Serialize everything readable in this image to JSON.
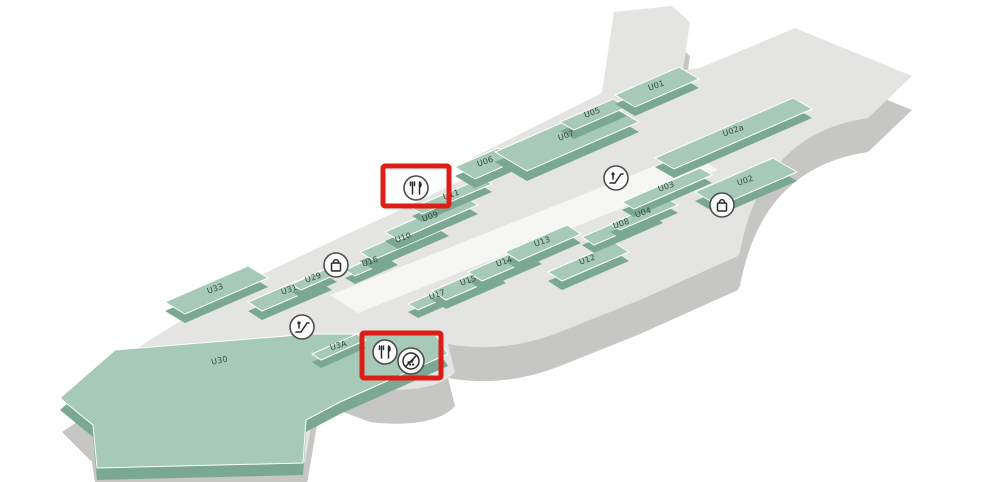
{
  "map": {
    "units": [
      {
        "label": "U01"
      },
      {
        "label": "U02a"
      },
      {
        "label": "U02"
      },
      {
        "label": "U03"
      },
      {
        "label": "U04"
      },
      {
        "label": "U05"
      },
      {
        "label": "U06"
      },
      {
        "label": "U07"
      },
      {
        "label": "U08"
      },
      {
        "label": "U09"
      },
      {
        "label": "U10"
      },
      {
        "label": "U11"
      },
      {
        "label": "U12"
      },
      {
        "label": "U13"
      },
      {
        "label": "U14"
      },
      {
        "label": "U15"
      },
      {
        "label": "U16"
      },
      {
        "label": "U17"
      },
      {
        "label": "U29"
      },
      {
        "label": "U31"
      },
      {
        "label": "U33"
      },
      {
        "label": "U3A"
      },
      {
        "label": "U30"
      }
    ],
    "amenity_icons": [
      {
        "name": "dining-icon",
        "symbol": "fork-knife",
        "highlighted": true
      },
      {
        "name": "dining-icon",
        "symbol": "fork-knife",
        "highlighted": true
      },
      {
        "name": "no-cart-icon",
        "symbol": "circle-slash",
        "highlighted": true
      },
      {
        "name": "escalator-icon",
        "symbol": "escalator",
        "highlighted": false
      },
      {
        "name": "escalator-icon",
        "symbol": "escalator",
        "highlighted": false
      },
      {
        "name": "shopping-icon",
        "symbol": "shopping-bag",
        "highlighted": false
      },
      {
        "name": "shopping-icon",
        "symbol": "shopping-bag",
        "highlighted": false
      }
    ],
    "highlight_count": 2,
    "colors": {
      "background": "#ffffff",
      "platform_top": "#e4e4e2",
      "platform_side": "#c6c6c4",
      "unit_top": "#a6cab7",
      "unit_side": "#7aa893",
      "highlight": "#dd1d16"
    }
  }
}
